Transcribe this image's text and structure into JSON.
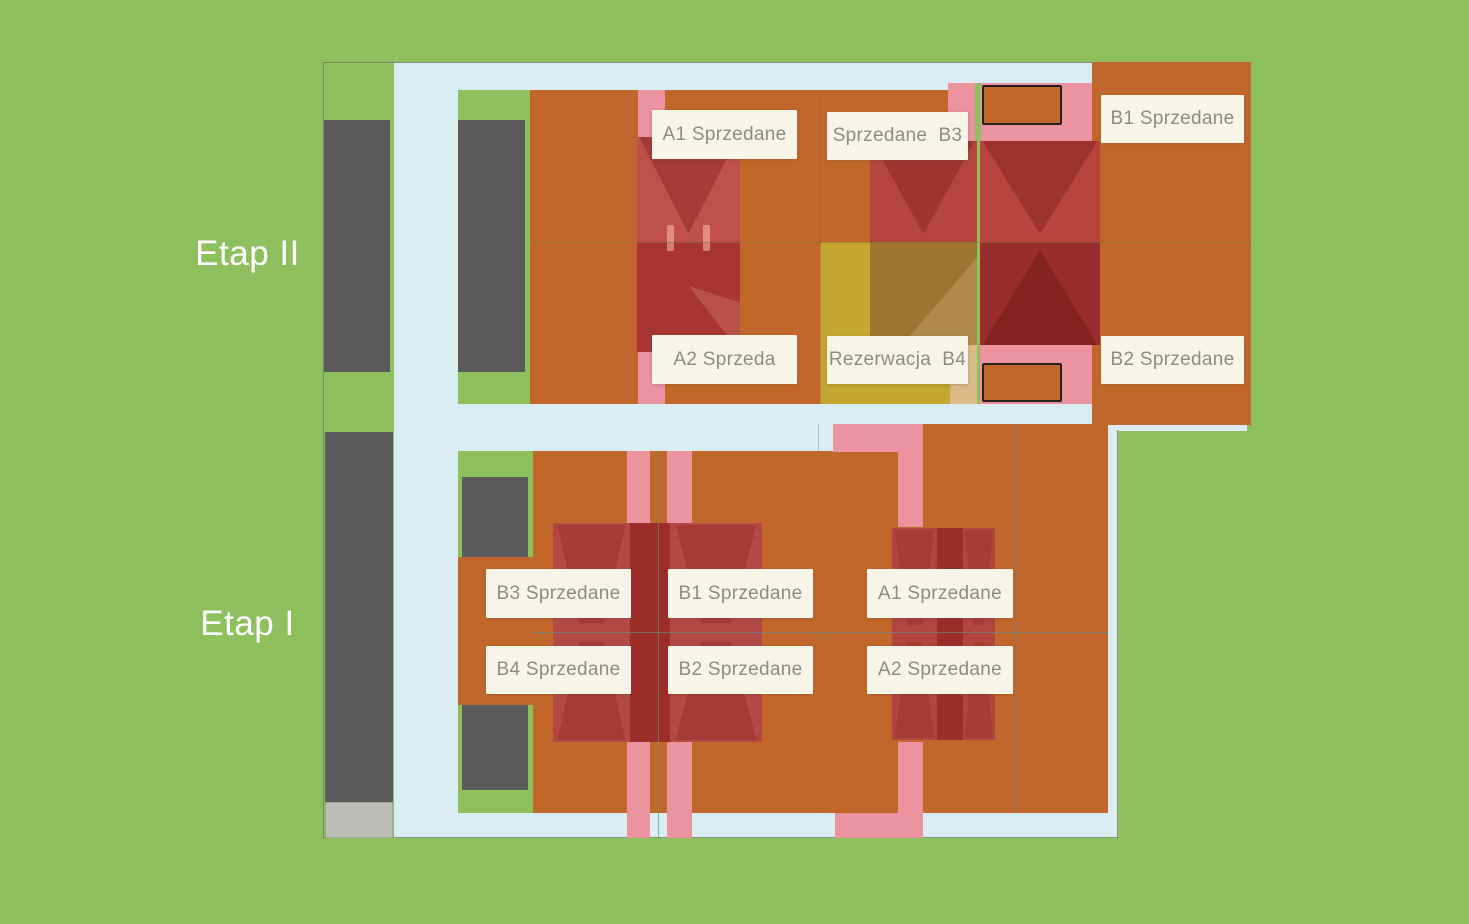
{
  "phases": [
    {
      "name": "Etap II",
      "plots": [
        {
          "code": "A1",
          "label": "A1 Sprzedane"
        },
        {
          "code": "B3",
          "label": "Sprzedane  B3"
        },
        {
          "code": "B1",
          "label": "B1 Sprzedane"
        },
        {
          "code": "A2",
          "label": "A2 Sprzeda"
        },
        {
          "code": "B4",
          "label": "Rezerwacja  B4"
        },
        {
          "code": "B2",
          "label": "B2 Sprzedane"
        }
      ]
    },
    {
      "name": "Etap I",
      "plots": [
        {
          "code": "B3",
          "label": "B3 Sprzedane"
        },
        {
          "code": "B1",
          "label": "B1 Sprzedane"
        },
        {
          "code": "A1",
          "label": "A1 Sprzedane"
        },
        {
          "code": "B4",
          "label": "B4 Sprzedane"
        },
        {
          "code": "B2",
          "label": "B2 Sprzedane"
        },
        {
          "code": "A2",
          "label": "A2 Sprzedane"
        }
      ]
    }
  ],
  "colors": {
    "background_grass": "#8ec05e",
    "road": "#d9edf3",
    "plot_sold_orange": "#c2672b",
    "plot_reserved_yellow": "#c4a630",
    "driveway_pink": "#ec93a0",
    "roof_red_light": "#c0504c",
    "roof_red_dark": "#a83434",
    "roof_reserved_olive": "#9f742e",
    "building_gray": "#5b5b5b",
    "building_gray_light": "#bdbdb8",
    "label_background": "#f7f5e7",
    "label_text": "#8c8c80",
    "phase_text": "#ffffff"
  }
}
